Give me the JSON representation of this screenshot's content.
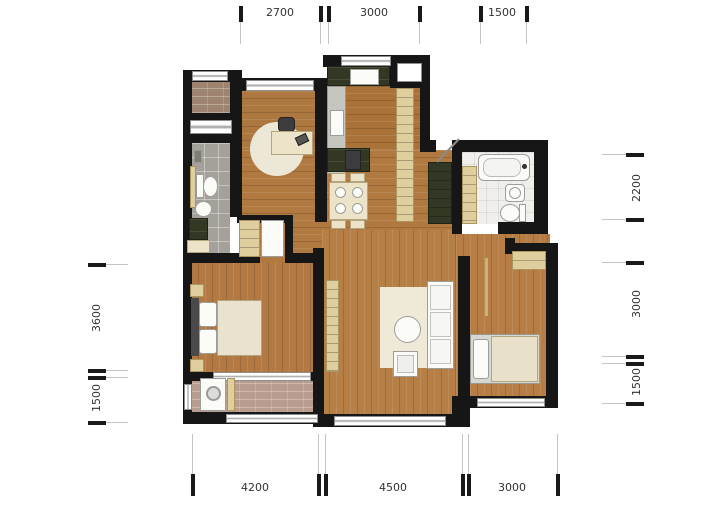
{
  "plan": {
    "type": "apartment-floor-plan",
    "rooms": [
      "balcony-top-left",
      "bathroom-left",
      "study",
      "kitchen",
      "dining-area",
      "hallway",
      "entry",
      "bathroom-right",
      "master-bedroom",
      "living-room",
      "bedroom-2",
      "laundry-balcony"
    ],
    "colors": {
      "wall": "#161616",
      "wood_floor": "#b07940",
      "brick_balcony": "#9d8370",
      "brick_laundry": "#b89c8d",
      "gray_tile": "#a3a19a",
      "white_tile": "#f0efeb",
      "cream_furniture": "#ece3c8",
      "light_wood_cabinet": "#e0cf9e",
      "dark_green_cabinet": "#323823"
    }
  },
  "dimensions": {
    "top": [
      "2700",
      "3000",
      "1500"
    ],
    "right": [
      "2200",
      "3000",
      "1500"
    ],
    "left": [
      "3600",
      "1500"
    ],
    "bottom": [
      "4200",
      "4500",
      "3000"
    ]
  }
}
